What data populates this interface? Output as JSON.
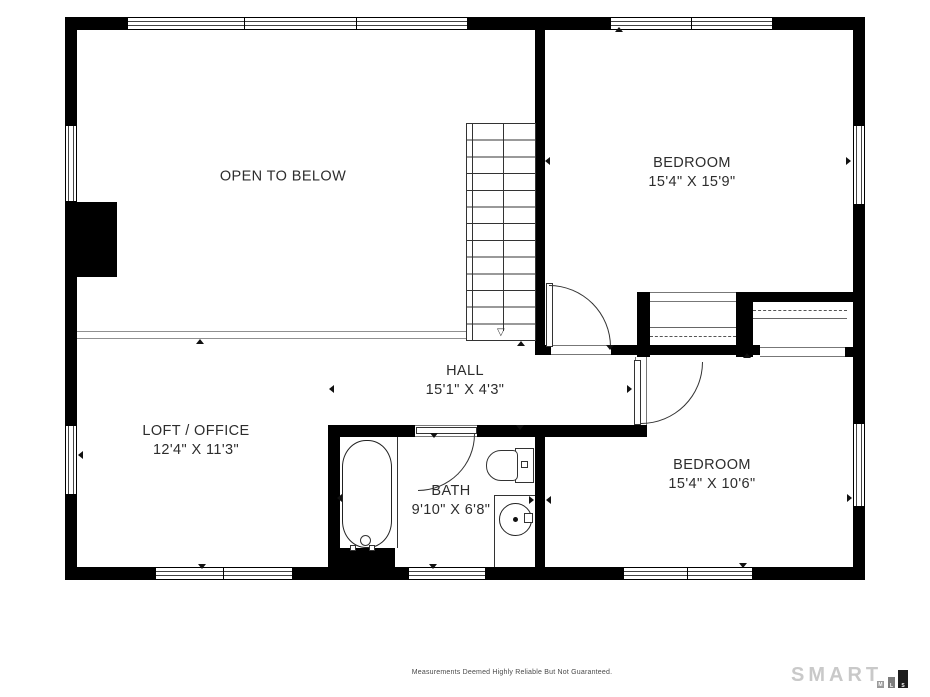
{
  "plan": {
    "rooms": [
      {
        "name": "OPEN TO BELOW",
        "dims": ""
      },
      {
        "name": "BEDROOM",
        "dims": "15'4\" X 15'9\""
      },
      {
        "name": "HALL",
        "dims": "15'1\" X 4'3\""
      },
      {
        "name": "LOFT / OFFICE",
        "dims": "12'4\" X 11'3\""
      },
      {
        "name": "BATH",
        "dims": "9'10\" X 6'8\""
      },
      {
        "name": "BEDROOM",
        "dims": "15'4\" X 10'6\""
      }
    ],
    "stair_direction_glyph": "▽"
  },
  "footer": {
    "disclaimer": "Measurements Deemed Highly Reliable But Not Guaranteed."
  },
  "logo": {
    "brand": "SMART",
    "blocks": [
      "M",
      "L",
      "S"
    ]
  },
  "colors": {
    "wall": "#000000",
    "text": "#2d2d2d",
    "logo_gray": "#c9c9c9"
  }
}
